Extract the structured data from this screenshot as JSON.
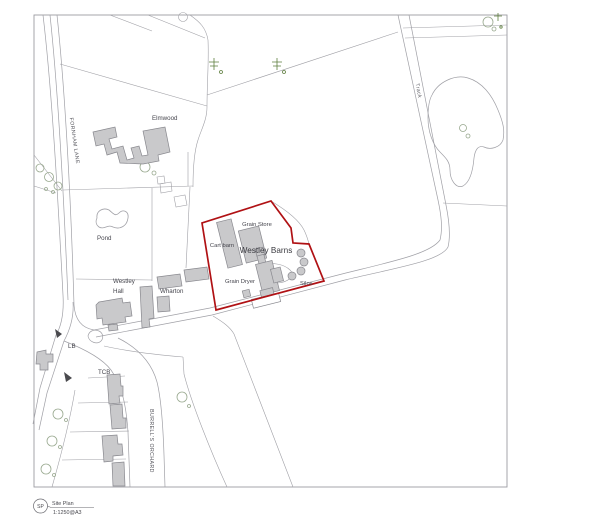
{
  "map": {
    "labels": {
      "fornham_lane": "FORNHAM LANE",
      "elmwood": "Elmwood",
      "pond": "Pond",
      "grain_store": "Grain Store",
      "cart_barn": "Cart barn",
      "westley_barns": "Westley Barns",
      "grain_dryer": "Grain Dryer",
      "silos": "Silos",
      "westley": "Westley",
      "hall": "Hall",
      "wharton": "Wharton",
      "lb": "LB",
      "tcb": "TCB",
      "burrells_orchard": "BURRELL'S ORCHARD",
      "track": "Track"
    }
  },
  "title_block": {
    "ref": "SP",
    "title": "Site Plan",
    "scale": "1:1250@A3"
  },
  "colors": {
    "site_boundary_color": "#b01114",
    "building_fill": "#c9c9cb",
    "building_stroke": "#88888e",
    "line_color": "#a0a0a6",
    "frame_line": "#9c9ca2",
    "tree_color": "#98a88e",
    "conifer_color": "#5f7f3f",
    "label_color": "#45454d"
  }
}
